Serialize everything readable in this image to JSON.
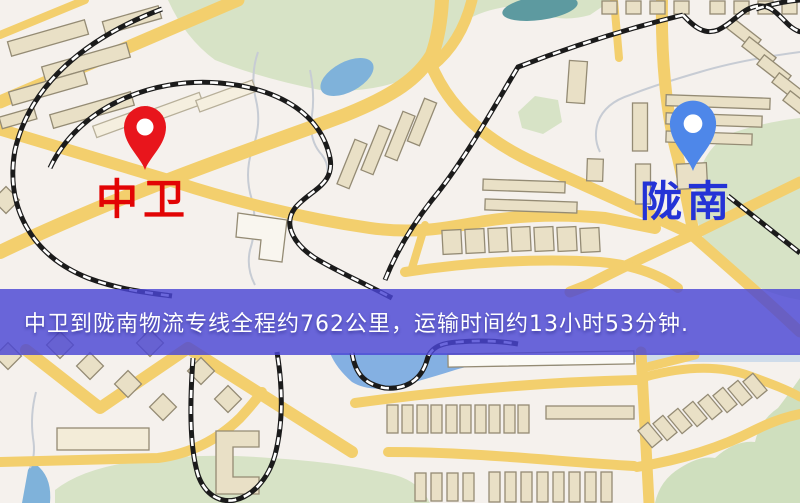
{
  "markers": {
    "origin": {
      "label": "中卫",
      "label_color": "#e20404",
      "pin_color": "#e8151c",
      "icon": "map-pin-icon"
    },
    "destination": {
      "label": "陇南",
      "label_color": "#2433d6",
      "pin_color": "#4e87e9",
      "icon": "map-pin-icon"
    }
  },
  "banner": {
    "text": "中卫到陇南物流专线全程约762公里，运输时间约13小时53分钟.",
    "bg_color": "#4a46d4",
    "text_color": "#ffffff",
    "route": {
      "distance": "762公里",
      "duration": "13小时53分钟"
    }
  },
  "map_colors": {
    "background": "#f5f1ed",
    "road": "#f3cf6d",
    "park": "#d7e3c6",
    "water": "#7fb2da",
    "pond_teal": "#5d9aa0",
    "building": "#e9e0c6",
    "railway": "#1b1b1b"
  }
}
